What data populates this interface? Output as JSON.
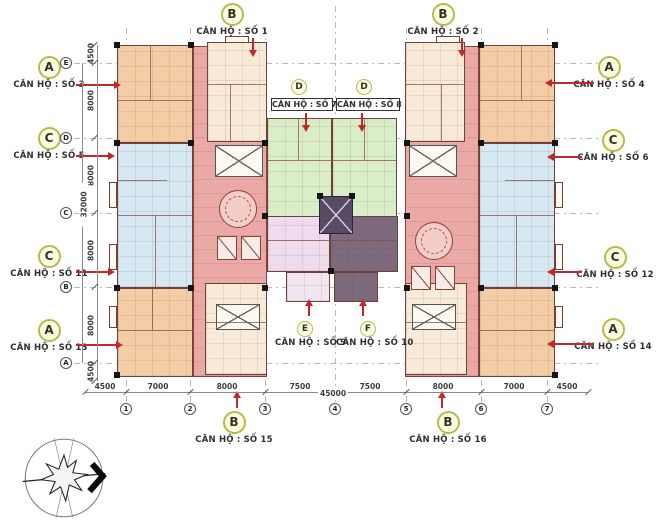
{
  "units": [
    {
      "no": "1",
      "letter": "B",
      "label": "CĂN HỘ : SỐ 1"
    },
    {
      "no": "2",
      "letter": "B",
      "label": "CĂN HỘ : SỐ 2"
    },
    {
      "no": "3",
      "letter": "A",
      "label": "CĂN HỘ : SỐ 3"
    },
    {
      "no": "4",
      "letter": "A",
      "label": "CĂN HỘ : SỐ 4"
    },
    {
      "no": "5",
      "letter": "C",
      "label": "CĂN HỘ : SỐ 5"
    },
    {
      "no": "6",
      "letter": "C",
      "label": "CĂN HỘ : SỐ 6"
    },
    {
      "no": "7",
      "letter": "D",
      "label": "CĂN HỘ : SỐ 7"
    },
    {
      "no": "8",
      "letter": "D",
      "label": "CĂN HỘ : SỐ 8"
    },
    {
      "no": "9",
      "letter": "E",
      "label": "CĂN HỘ : SỐ 9"
    },
    {
      "no": "10",
      "letter": "F",
      "label": "CĂN HỘ : SỐ 10"
    },
    {
      "no": "11",
      "letter": "C",
      "label": "CĂN HỘ : SỐ 11"
    },
    {
      "no": "12",
      "letter": "C",
      "label": "CĂN HỘ : SỐ 12"
    },
    {
      "no": "13",
      "letter": "A",
      "label": "CĂN HỘ : SỐ 13"
    },
    {
      "no": "14",
      "letter": "A",
      "label": "CĂN HỘ : SỐ 14"
    },
    {
      "no": "15",
      "letter": "B",
      "label": "CĂN HỘ : SỐ 15"
    },
    {
      "no": "16",
      "letter": "B",
      "label": "CĂN HỘ : SỐ 16"
    }
  ],
  "grid": {
    "cols": [
      "1",
      "2",
      "3",
      "4",
      "5",
      "6",
      "7"
    ],
    "rows": [
      "E",
      "D",
      "C",
      "B",
      "A"
    ]
  },
  "dims": {
    "bottom_segments": [
      "4500",
      "7000",
      "8000",
      "7500",
      "7500",
      "8000",
      "7000",
      "4500"
    ],
    "bottom_total": "45000",
    "left_segments": [
      "4500",
      "8000",
      "8000",
      "8000",
      "8000",
      "4500"
    ],
    "left_total": "32000"
  },
  "colors": {
    "unit_orange": "#f3cda6",
    "unit_pale": "#f7ead6",
    "unit_blue": "#d6e8f2",
    "unit_green": "#d9edc8",
    "unit_pink": "#eedcee",
    "unit_purple": "#7d6b7d",
    "corridor_salmon": "#eba9a5",
    "wall": "#72413a",
    "arrow_red": "#c1272d",
    "badge_fill": "#fcfce6",
    "badge_border": "#b9b94a"
  },
  "icons": {
    "compass": "north-arrow-compass"
  }
}
